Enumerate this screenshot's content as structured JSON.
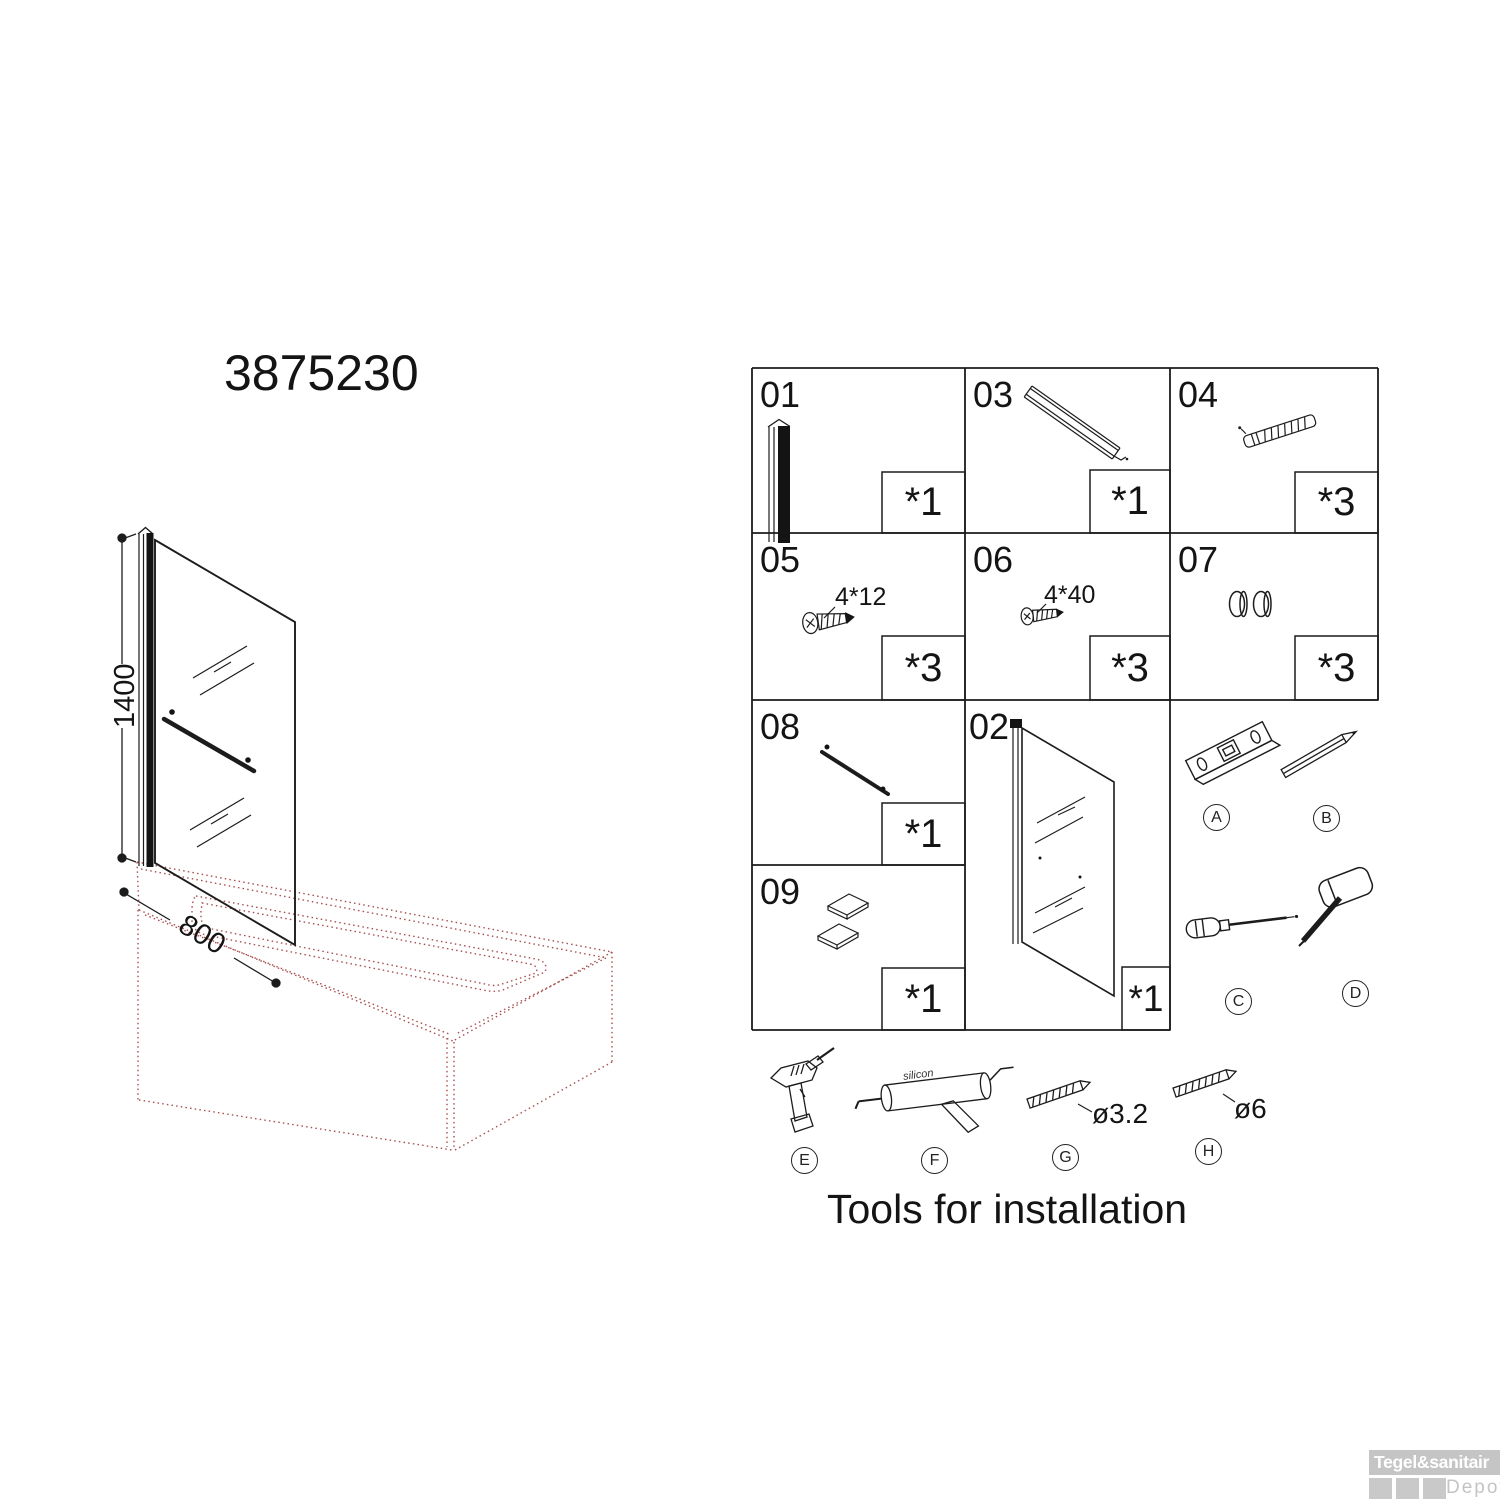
{
  "header": {
    "product_code": "3875230"
  },
  "diagram": {
    "height_label": "1400",
    "width_label": "800"
  },
  "parts": {
    "p01": {
      "num": "01",
      "qty": "*1"
    },
    "p02": {
      "num": "02",
      "qty": "*1"
    },
    "p03": {
      "num": "03",
      "qty": "*1"
    },
    "p04": {
      "num": "04",
      "qty": "*3"
    },
    "p05": {
      "num": "05",
      "qty": "*3",
      "size": "4*12"
    },
    "p06": {
      "num": "06",
      "qty": "*3",
      "size": "4*40"
    },
    "p07": {
      "num": "07",
      "qty": "*3"
    },
    "p08": {
      "num": "08",
      "qty": "*1"
    },
    "p09": {
      "num": "09",
      "qty": "*1"
    }
  },
  "tools": {
    "caption": "Tools for installation",
    "labels": {
      "a": "A",
      "b": "B",
      "c": "C",
      "d": "D",
      "e": "E",
      "f": "F",
      "g": "G",
      "h": "H"
    },
    "silicon_text": "silicon",
    "bit_small_label": "ø3.2",
    "bit_large_label": "ø6"
  },
  "watermark": {
    "brand": "Tegel&sanitair",
    "sub": "Depot"
  },
  "colors": {
    "line": "#1c1c1c",
    "bath_dashed": "#a85050",
    "watermark_gray": "#c5c5c5"
  }
}
